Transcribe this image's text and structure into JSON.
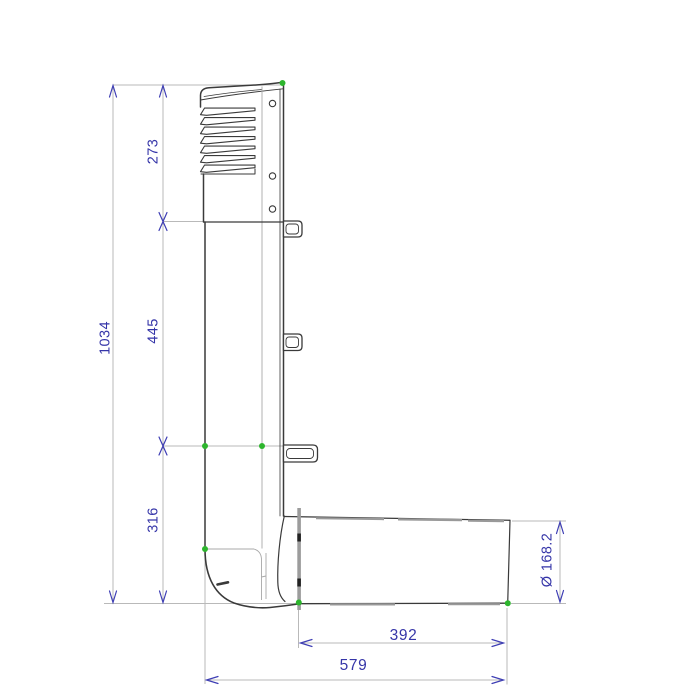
{
  "drawing": {
    "type": "technical-dimension-drawing",
    "subject": "Vent pipe assembly with louvered hood and 90-degree elbow, side elevation",
    "dimensions": {
      "total_height": "1034",
      "hood_section_height": "273",
      "mid_section_height": "445",
      "bottom_section_height": "316",
      "horizontal_pipe_length": "392",
      "total_horizontal_extent": "579",
      "pipe_diameter": "Ø 168.2"
    },
    "colors": {
      "dimension_text": "#3535a8",
      "dimension_arrow": "#3d3db4",
      "dimension_line": "#b9b9b9",
      "object_line": "#3a3a3a",
      "aux_line": "#a8a8a8",
      "endpoint_marker": "#2db52d",
      "background": "#ffffff"
    }
  }
}
